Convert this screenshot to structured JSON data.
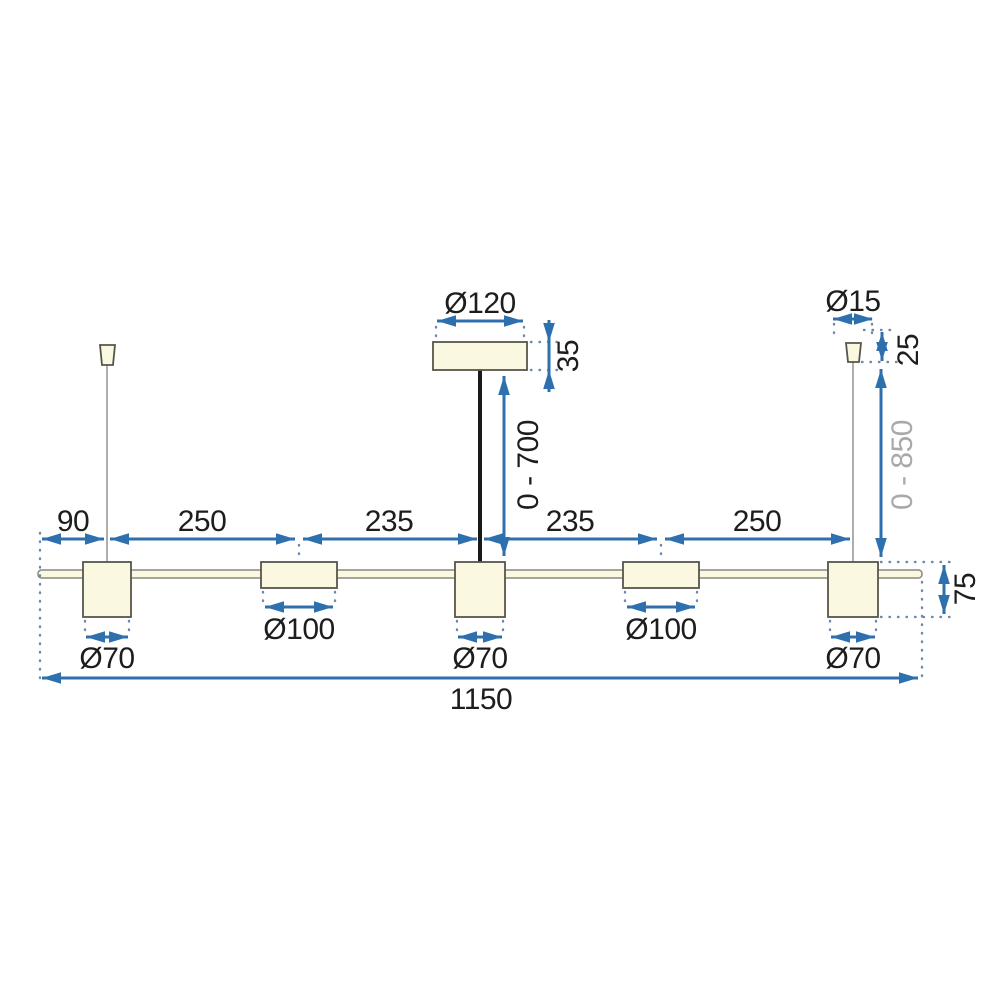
{
  "drawing": {
    "type": "technical-dimension-drawing",
    "subject": "linear-pendant-lamp-5-shades",
    "labels": {
      "canopy_diameter": "Ø120",
      "canopy_height": "35",
      "rod_drop_range": "0 - 700",
      "cable_cap_diameter": "Ø15",
      "cable_cap_height": "25",
      "cable_drop_range": "0 - 850",
      "offset_left": "90",
      "span_1": "250",
      "span_2": "235",
      "span_3": "235",
      "span_4": "250",
      "shade_1_diameter": "Ø70",
      "shade_2_diameter": "Ø100",
      "shade_3_diameter": "Ø70",
      "shade_4_diameter": "Ø100",
      "shade_5_diameter": "Ø70",
      "fixture_height": "75",
      "total_length": "1150"
    }
  },
  "colors": {
    "dim": "#2e6fae",
    "ext": "#6b89ad",
    "outline": "#57564a",
    "part_fill": "#fbf8e2",
    "bar_outline": "#8a887c",
    "wire": "#9a9a9a",
    "rod": "#1a1a1a",
    "text": "#1d1d1b",
    "text_muted": "#a9a9a9",
    "background": "#ffffff"
  }
}
